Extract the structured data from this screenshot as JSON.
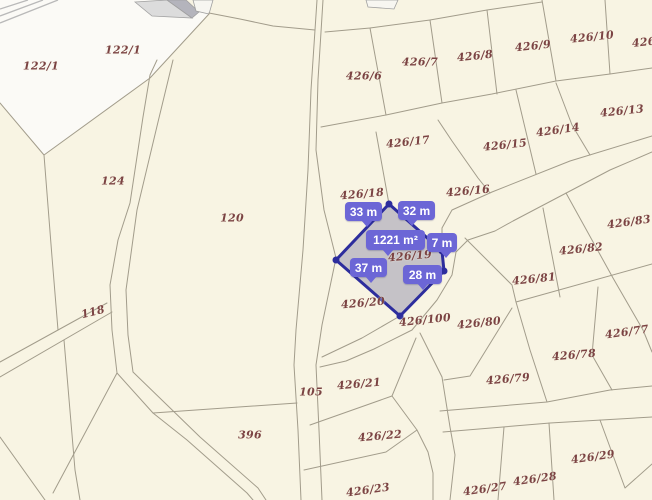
{
  "map": {
    "background_color": "#f8f4e3",
    "boundary_line_color": "#a29c8b",
    "label_color": "#7b4343",
    "white_area_color": "#fbfaf6",
    "hatch_color": "#b9b9b9",
    "building_colors": {
      "roof_light": "#dcdcdc",
      "roof_dark": "#b4b4bc",
      "outline": "#a0a0a0",
      "annex": "#f7f6f1"
    },
    "parcel_labels": [
      {
        "text": "122/1",
        "x": 41,
        "y": 66,
        "rot": 0
      },
      {
        "text": "122/1",
        "x": 123,
        "y": 50,
        "rot": 0
      },
      {
        "text": "124",
        "x": 113,
        "y": 181,
        "rot": 0
      },
      {
        "text": "120",
        "x": 232,
        "y": 218,
        "rot": 0
      },
      {
        "text": "118",
        "x": 93,
        "y": 312,
        "rot": -14
      },
      {
        "text": "396",
        "x": 250,
        "y": 435,
        "rot": 0
      },
      {
        "text": "105",
        "x": 311,
        "y": 392,
        "rot": 0
      },
      {
        "text": "426/6",
        "x": 364,
        "y": 76,
        "rot": 0
      },
      {
        "text": "426/7",
        "x": 420,
        "y": 62,
        "rot": 0
      },
      {
        "text": "426/8",
        "x": 475,
        "y": 56,
        "rot": -6
      },
      {
        "text": "426/9",
        "x": 533,
        "y": 46,
        "rot": -6
      },
      {
        "text": "426/10",
        "x": 592,
        "y": 37,
        "rot": -6
      },
      {
        "text": "426/",
        "x": 646,
        "y": 42,
        "rot": -6
      },
      {
        "text": "426/13",
        "x": 622,
        "y": 111,
        "rot": -6
      },
      {
        "text": "426/14",
        "x": 558,
        "y": 130,
        "rot": -8
      },
      {
        "text": "426/15",
        "x": 505,
        "y": 145,
        "rot": -6
      },
      {
        "text": "426/17",
        "x": 408,
        "y": 142,
        "rot": -6
      },
      {
        "text": "426/16",
        "x": 468,
        "y": 191,
        "rot": -5
      },
      {
        "text": "426/18",
        "x": 362,
        "y": 194,
        "rot": -5
      },
      {
        "text": "426/19",
        "x": 410,
        "y": 256,
        "rot": -5
      },
      {
        "text": "426/83",
        "x": 629,
        "y": 222,
        "rot": -8
      },
      {
        "text": "426/82",
        "x": 581,
        "y": 249,
        "rot": -6
      },
      {
        "text": "426/81",
        "x": 534,
        "y": 279,
        "rot": -6
      },
      {
        "text": "426/80",
        "x": 479,
        "y": 323,
        "rot": -6
      },
      {
        "text": "426/77",
        "x": 627,
        "y": 332,
        "rot": -8
      },
      {
        "text": "426/78",
        "x": 574,
        "y": 355,
        "rot": -5
      },
      {
        "text": "426/79",
        "x": 508,
        "y": 379,
        "rot": -5
      },
      {
        "text": "426/100",
        "x": 425,
        "y": 320,
        "rot": -6
      },
      {
        "text": "426/20",
        "x": 363,
        "y": 303,
        "rot": -5
      },
      {
        "text": "426/21",
        "x": 359,
        "y": 384,
        "rot": -5
      },
      {
        "text": "426/22",
        "x": 380,
        "y": 436,
        "rot": -5
      },
      {
        "text": "426/23",
        "x": 368,
        "y": 490,
        "rot": -8
      },
      {
        "text": "426/27",
        "x": 485,
        "y": 489,
        "rot": -8
      },
      {
        "text": "426/28",
        "x": 535,
        "y": 479,
        "rot": -8
      },
      {
        "text": "426/29",
        "x": 593,
        "y": 457,
        "rot": -8
      }
    ],
    "highlight_parcel": {
      "label": "426/19",
      "area": "1221 m²",
      "fill": "rgba(136,134,164,0.45)",
      "stroke": "#2d2d9d",
      "points": "389,204 442,251 444,271 400,316 336,260",
      "vertex_dots": [
        [
          389,
          204
        ],
        [
          442,
          251
        ],
        [
          444,
          271
        ],
        [
          400,
          316
        ],
        [
          336,
          260
        ]
      ],
      "dot_color": "#2d2d9d"
    },
    "measurement_bubbles": {
      "color": "#6c66d6",
      "text_color": "#ffffff",
      "items": [
        {
          "text": "33 m",
          "x": 345,
          "y": 202,
          "w": 37,
          "h": 19,
          "tail": 16
        },
        {
          "text": "32 m",
          "x": 398,
          "y": 201,
          "w": 37,
          "h": 19,
          "tail": 8
        },
        {
          "text": "1221 m²",
          "x": 366,
          "y": 230,
          "w": 59,
          "h": 20,
          "tail": 16
        },
        {
          "text": "7 m",
          "x": 427,
          "y": 233,
          "w": 30,
          "h": 19,
          "tail": 13
        },
        {
          "text": "37 m",
          "x": 350,
          "y": 258,
          "w": 37,
          "h": 19,
          "tail": 15
        },
        {
          "text": "28 m",
          "x": 403,
          "y": 265,
          "w": 39,
          "h": 19,
          "tail": 14
        }
      ]
    }
  }
}
